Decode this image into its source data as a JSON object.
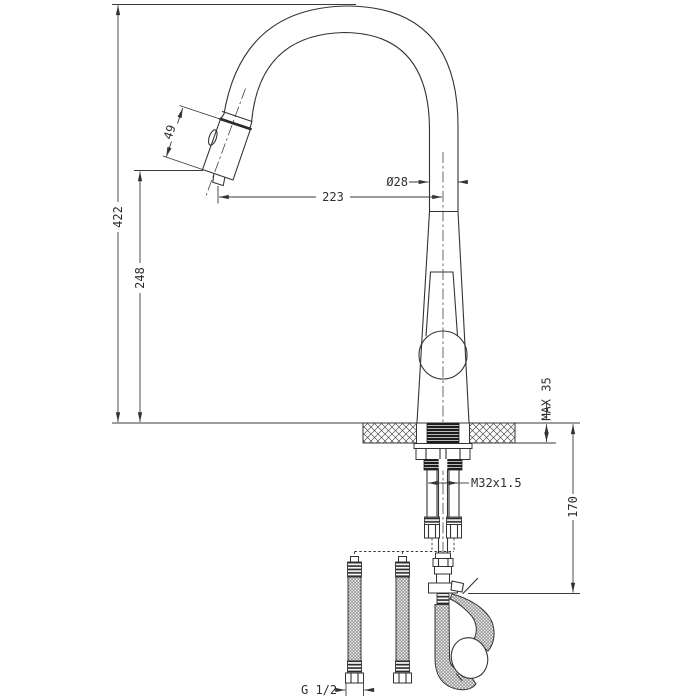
{
  "colors": {
    "line": "#3a3a3a",
    "background": "#ffffff"
  },
  "dimensions": {
    "overall_height": "422",
    "aerator_height": "248",
    "spout_reach": "223",
    "spray_head_length": "49",
    "spout_diameter": "Ø28",
    "max_deck_thickness": "MAX 35",
    "under_deck_length": "170",
    "mounting_thread": "M32x1.5",
    "hose_connection": "G 1/2"
  }
}
